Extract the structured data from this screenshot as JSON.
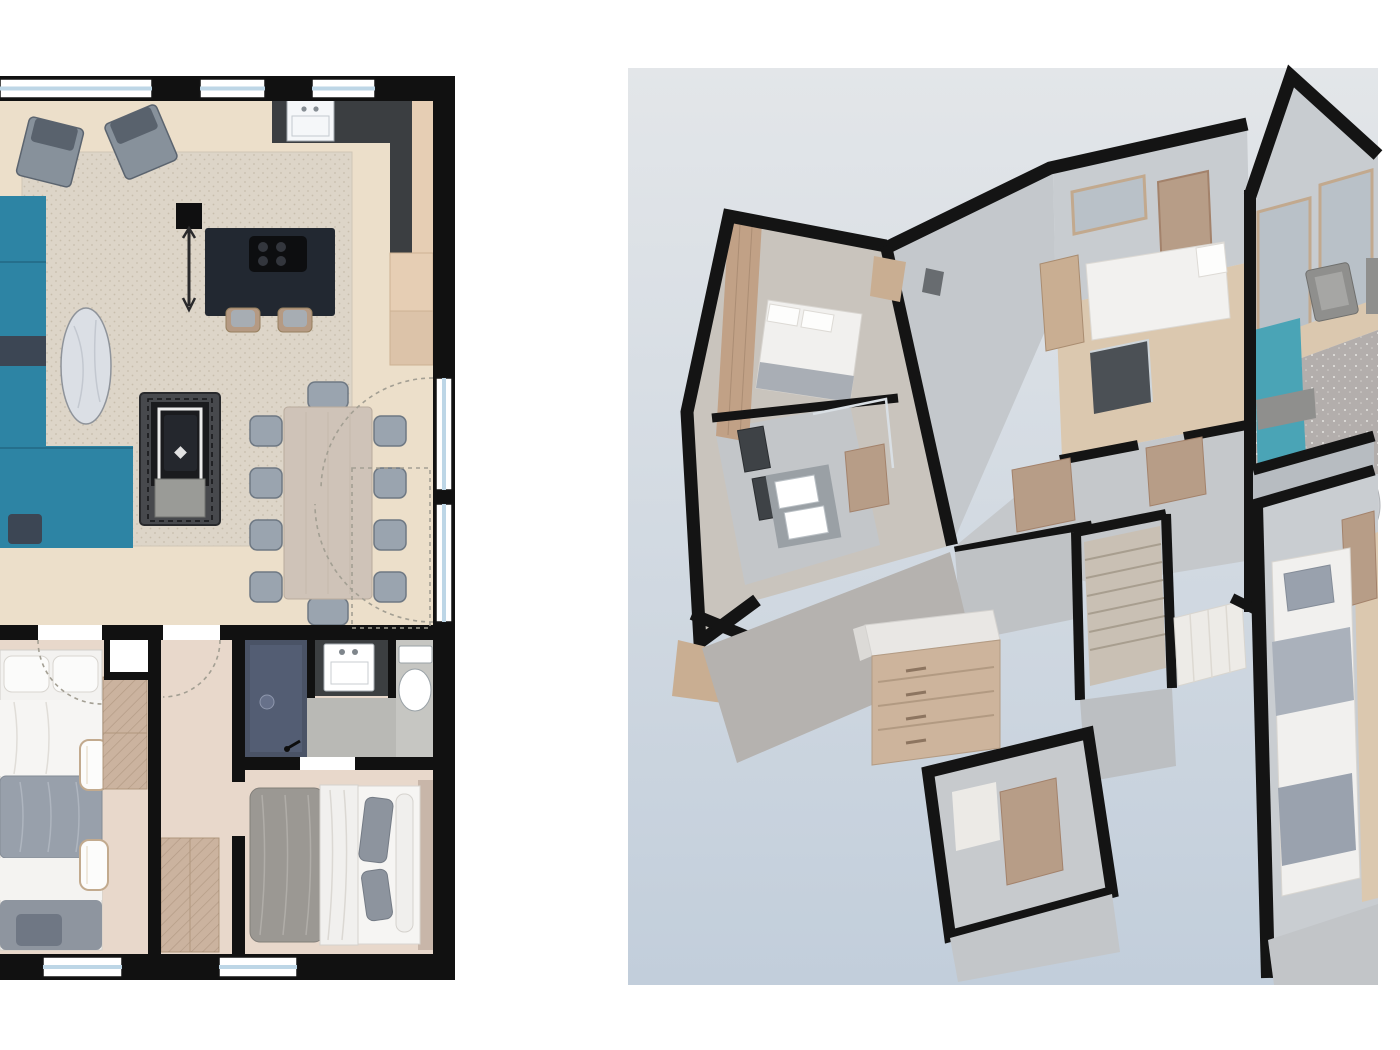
{
  "colors": {
    "page_bg": "#ffffff",
    "wall": "#111111",
    "floor_living": "#ecdfca",
    "floor_bedroom": "#e8d8cb",
    "rug2d": "#ddd5c8",
    "rug2d_dot": "#c8beac",
    "sofa_teal": "#2d84a4",
    "sofa_teal_dark": "#3c4654",
    "armchair": "#87919b",
    "armchair_cushion": "#59626d",
    "island": "#222831",
    "cooktop": "#0d0e10",
    "counter": "#3b3e41",
    "cabinet": "#e6ceb4",
    "cabinet2": "#dcc3a9",
    "stool": "#b59a83",
    "table_wood": "#cfc3b8",
    "chair": "#9aa4af",
    "fireplace": "#47494d",
    "fireplace_inner": "#1a1b1e",
    "hearth": "#9a9b97",
    "shower": "#4a5366",
    "tile": "#b9b9b5",
    "tile_light": "#c6c6c2",
    "vanity": "#3c3f41",
    "window_glass": "#bdd6e6",
    "wardrobe": "#cbb39f",
    "headboard": "#c8b6a9",
    "panel_top": "#e3e6e9",
    "panel_bottom": "#c2cedb",
    "wall3d": "#141414",
    "wood3d": "#c9ae92",
    "wood3d_light": "#dbc8af",
    "door3d": "#b79d87",
    "teal3d": "#4aa4b6",
    "rug3d": "#b3aeac",
    "glass3d": "#b9c1c8",
    "stair": "#c9c0b4"
  },
  "plan2d": {
    "view": "top-down 2D floor plan, cropped at left edge",
    "rooms": [
      "living-room",
      "kitchen",
      "dining-area",
      "hallway",
      "bathroom",
      "bedroom-left",
      "bedroom-right"
    ],
    "furniture": [
      "teal-sectional-sofa",
      "armchair",
      "armchair",
      "oval-marble-coffee-table",
      "floor-lamp",
      "kitchen-island-with-cooktop",
      "bar-stool",
      "bar-stool",
      "kitchen-counter-with-sink",
      "tall-cabinets",
      "fireplace-stove",
      "dining-table-10-chairs",
      "bunk-bed",
      "desk-chair",
      "desk-chair",
      "wardrobe",
      "wardrobe",
      "shower",
      "double-vanity-sink",
      "toilet",
      "double-bed"
    ],
    "openings": [
      "top-wall-windows-x3",
      "right-wall-windows-x2",
      "bottom-wall-windows-x2",
      "door-swing-arcs",
      "dashed-terrace-zone"
    ]
  },
  "plan3d": {
    "view": "isometric dollhouse cutaway on light-blue panel",
    "rooms": [
      "master-bedroom",
      "ensuite-bathroom",
      "middle-bedroom",
      "shower-room",
      "hallway",
      "stairs",
      "living-room",
      "lower-bedroom",
      "utility-room"
    ],
    "furniture": [
      "double-bed",
      "double-vanity-with-mirrors",
      "bed-white",
      "wardrobe",
      "teal-sofa",
      "gray-armchairs",
      "sparkle-rug",
      "oval-side-table",
      "chest-of-drawers",
      "bunk-bed",
      "staircase",
      "tan-doors",
      "gable-windows"
    ]
  }
}
